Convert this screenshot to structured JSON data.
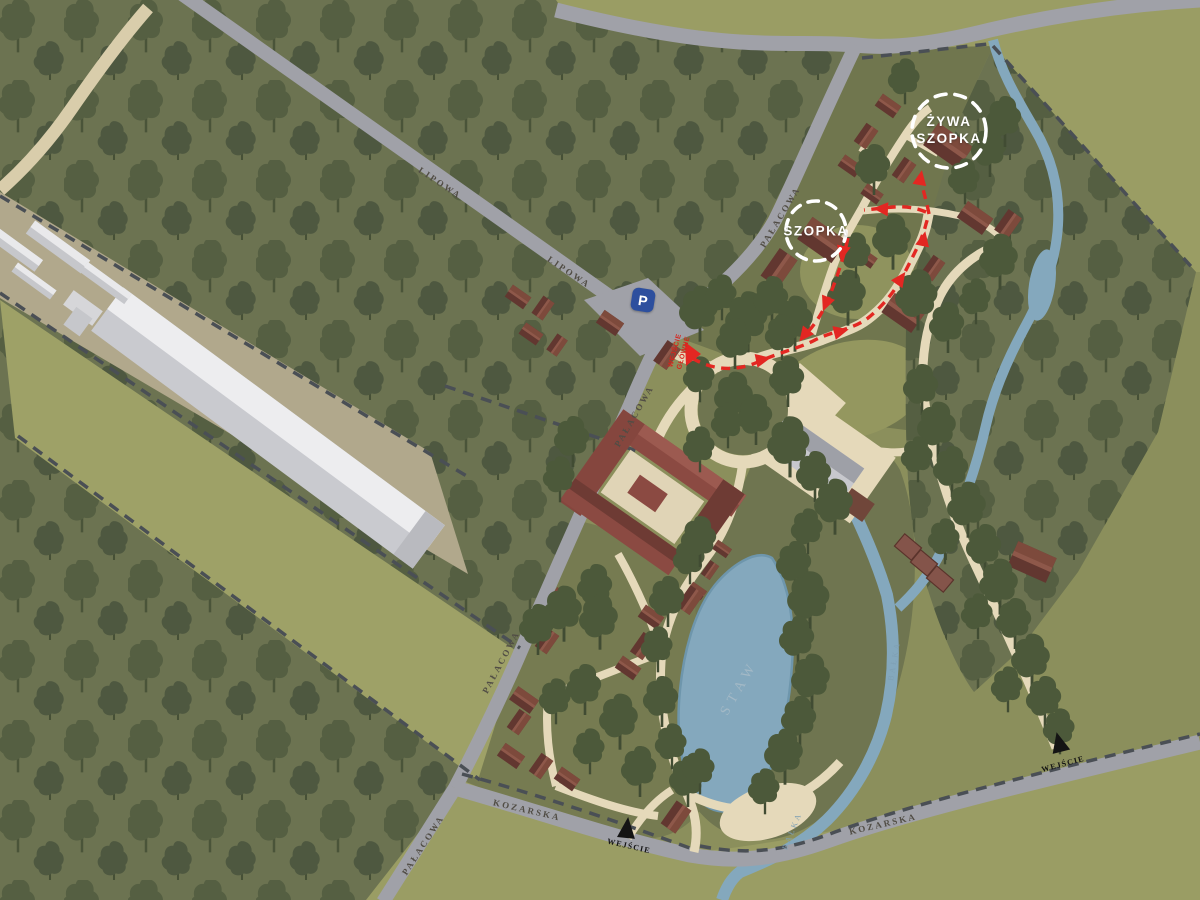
{
  "labels": {
    "streets": {
      "lipowa": "LIPOWA",
      "palacowa": "PAŁACOWA",
      "kozarska": "KOZARSKA"
    },
    "entrances": {
      "entrance": "WEJŚCIE",
      "main_entrance_line1": "WEJŚCIE",
      "main_entrance_line2": "GŁÓWNE"
    },
    "pois": {
      "szopka": "SZOPKA",
      "zywa_szopka_line1": "ŻYWA",
      "zywa_szopka_line2": "SZOPKA"
    },
    "water": {
      "pond": "STAW",
      "river": "BAŁKA"
    },
    "parking": "P"
  },
  "colors": {
    "route_red": "#E32722",
    "water_blue": "#84A8BD",
    "forest_green": "#6C7351",
    "grass_light": "#9A9D64",
    "road_gray": "#A0A1A8",
    "path_beige": "#E5D9BA",
    "building_brown": "#7D4A3C",
    "boundary_dark": "#4A4F55",
    "highlight_white": "#FFFFFF",
    "parking_blue": "#2D4F9E"
  }
}
